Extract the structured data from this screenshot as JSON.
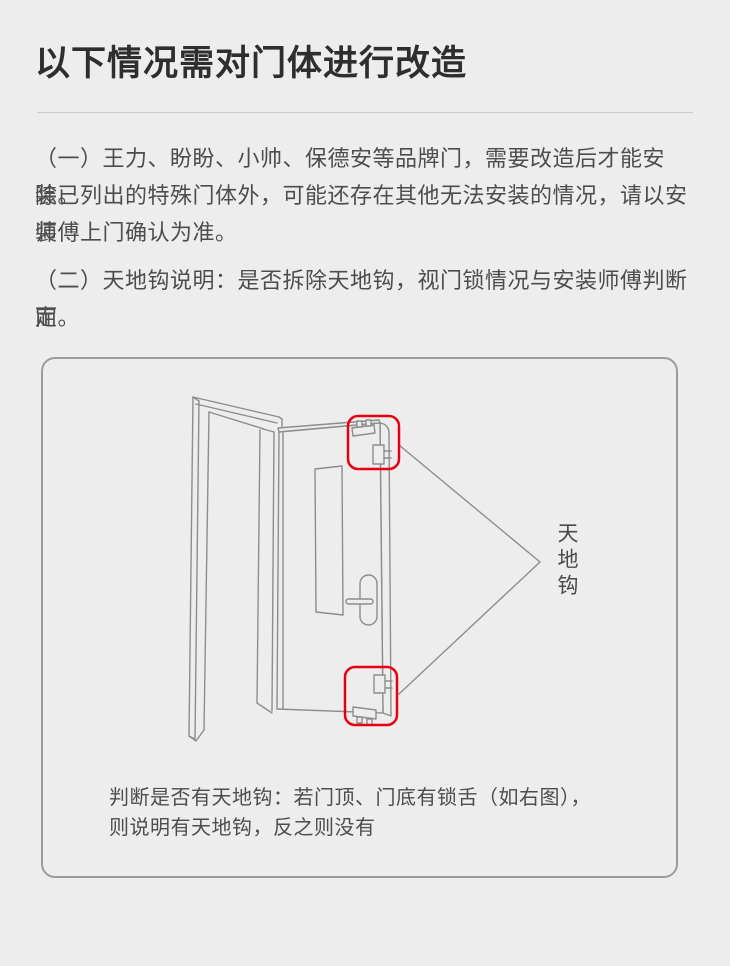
{
  "page": {
    "title": "以下情况需对门体进行改造",
    "paragraphs": [
      {
        "lines": [
          "（一）王力、盼盼、小帅、保德安等品牌门，需要改造后才能安装。",
          "除已列出的特殊门体外，可能还存在其他无法安装的情况，请以安装",
          "师傅上门确认为准。"
        ]
      },
      {
        "lines": [
          "（二）天地钩说明：是否拆除天地钩，视门锁情况与安装师傅判断而",
          "定。"
        ]
      }
    ],
    "diagram": {
      "hook_label": "天地钩",
      "caption_lines": [
        "判断是否有天地钩：若门顶、门底有锁舌（如右图），",
        "则说明有天地钩，反之则没有"
      ],
      "colors": {
        "background": "#ededed",
        "highlight": "#e60012",
        "line_art": "#8d8d8d",
        "box_border": "#9b9b9b",
        "text": "#4d4d4d"
      }
    }
  }
}
